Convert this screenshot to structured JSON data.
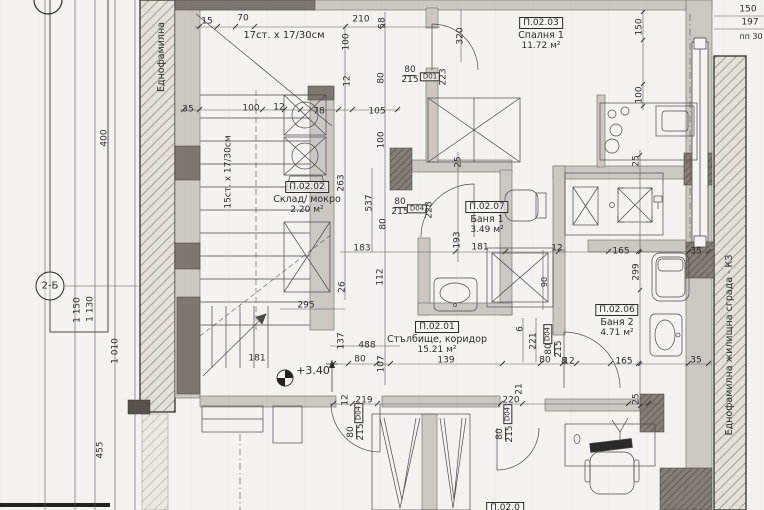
{
  "palette": {
    "paper": "#f3f2ef",
    "ink": "#3c3c3c",
    "wall_light": "#cbc7c2",
    "wall_dark": "#7d7772"
  },
  "side_labels": {
    "left": "Еднофамилна",
    "right": "Еднофамилна жилищна сграда - КЗ"
  },
  "grid_markers": [
    {
      "label": "2-Б",
      "x": 50,
      "y": 286
    }
  ],
  "level_marker": {
    "label": "+3.40"
  },
  "stair_notes": {
    "top": "17ст. х 17/30см",
    "side": "15ст. х 17/30см"
  },
  "rooms": [
    {
      "id": "П.02.01",
      "name": "Стълбище, коридор",
      "area": "15.21 м²",
      "x": 437,
      "y": 338
    },
    {
      "id": "П.02.02",
      "name": "Склад/ мокро",
      "area": "2.20 м²",
      "x": 307,
      "y": 198
    },
    {
      "id": "П.02.03",
      "name": "Спалня 1",
      "area": "11.72 м²",
      "x": 541,
      "y": 34
    },
    {
      "id": "П.02.06",
      "name": "Баня 2",
      "area": "4.71 м²",
      "x": 617,
      "y": 321
    },
    {
      "id": "П.02.07",
      "name": "Баня 1",
      "area": "3.49 м²",
      "x": 487,
      "y": 218
    },
    {
      "id": "П.02.0",
      "name": "",
      "area": "",
      "x": 505,
      "y": 508
    }
  ],
  "texts": [
    {
      "t": "15",
      "x": 207,
      "y": 22
    },
    {
      "t": "70",
      "x": 243,
      "y": 19
    },
    {
      "t": "210",
      "x": 361,
      "y": 20
    },
    {
      "t": "58",
      "x": 383,
      "y": 23,
      "r": -90
    },
    {
      "t": "320",
      "x": 461,
      "y": 36,
      "r": -90
    },
    {
      "t": "150",
      "x": 748,
      "y": 10
    },
    {
      "t": "197",
      "x": 750,
      "y": 23
    },
    {
      "t": "пп 30",
      "x": 751,
      "y": 37,
      "s": 8,
      "n": "note-pp30"
    },
    {
      "t": "150",
      "x": 640,
      "y": 27,
      "r": -90
    },
    {
      "t": "100",
      "x": 640,
      "y": 95,
      "r": -90
    },
    {
      "t": "100",
      "x": 347,
      "y": 42,
      "r": -90
    },
    {
      "t": "12",
      "x": 348,
      "y": 81,
      "r": -90
    },
    {
      "t": "80",
      "x": 382,
      "y": 78,
      "r": -90
    },
    {
      "t": "35",
      "x": 188,
      "y": 110
    },
    {
      "t": "100",
      "x": 251,
      "y": 109
    },
    {
      "t": "12",
      "x": 279,
      "y": 108
    },
    {
      "t": "78",
      "x": 319,
      "y": 112
    },
    {
      "t": "105",
      "x": 377,
      "y": 112
    },
    {
      "t": "263",
      "x": 342,
      "y": 183,
      "r": -90
    },
    {
      "t": "100",
      "x": 382,
      "y": 140,
      "r": -90
    },
    {
      "t": "537",
      "x": 370,
      "y": 203,
      "r": -90
    },
    {
      "t": "80",
      "x": 384,
      "y": 224,
      "r": -90
    },
    {
      "t": "183",
      "x": 362,
      "y": 249
    },
    {
      "t": "112",
      "x": 381,
      "y": 277,
      "r": -90
    },
    {
      "t": "26",
      "x": 343,
      "y": 287,
      "r": -90
    },
    {
      "t": "295",
      "x": 306,
      "y": 306
    },
    {
      "t": "137",
      "x": 342,
      "y": 341,
      "r": -90
    },
    {
      "t": "488",
      "x": 367,
      "y": 346
    },
    {
      "t": "80",
      "x": 360,
      "y": 360
    },
    {
      "t": "107",
      "x": 382,
      "y": 364,
      "r": -90
    },
    {
      "t": "139",
      "x": 446,
      "y": 361
    },
    {
      "t": "80",
      "x": 545,
      "y": 361
    },
    {
      "t": "8",
      "x": 564,
      "y": 362
    },
    {
      "t": "181",
      "x": 257,
      "y": 359
    },
    {
      "t": "12",
      "x": 346,
      "y": 400,
      "r": -90
    },
    {
      "t": "219",
      "x": 364,
      "y": 401
    },
    {
      "t": "220",
      "x": 511,
      "y": 401
    },
    {
      "t": "21",
      "x": 520,
      "y": 389,
      "r": -90
    },
    {
      "t": "25",
      "x": 637,
      "y": 399,
      "r": -90
    },
    {
      "t": "6",
      "x": 521,
      "y": 329,
      "r": -90
    },
    {
      "t": "221",
      "x": 534,
      "y": 341,
      "r": -90
    },
    {
      "t": "165",
      "x": 621,
      "y": 252
    },
    {
      "t": "35",
      "x": 696,
      "y": 252
    },
    {
      "t": "299",
      "x": 637,
      "y": 272,
      "r": -90
    },
    {
      "t": "165",
      "x": 624,
      "y": 362
    },
    {
      "t": "12",
      "x": 569,
      "y": 362
    },
    {
      "t": "35",
      "x": 696,
      "y": 361
    },
    {
      "t": "25",
      "x": 459,
      "y": 162,
      "r": -90
    },
    {
      "t": "25",
      "x": 637,
      "y": 161,
      "r": -90
    },
    {
      "t": "193",
      "x": 458,
      "y": 240,
      "r": -90
    },
    {
      "t": "181",
      "x": 480,
      "y": 248
    },
    {
      "t": "12",
      "x": 557,
      "y": 249
    },
    {
      "t": "90",
      "x": 545,
      "y": 282,
      "r": -90,
      "s": 8
    },
    {
      "t": "400",
      "x": 105,
      "y": 138,
      "r": -90
    },
    {
      "t": "1 150",
      "x": 78,
      "y": 310,
      "r": -90
    },
    {
      "t": "1 130",
      "x": 91,
      "y": 309,
      "r": -90
    },
    {
      "t": "1 010",
      "x": 116,
      "y": 351,
      "r": -90
    },
    {
      "t": "455",
      "x": 101,
      "y": 450,
      "r": -90
    },
    {
      "t": "+3.40",
      "x": 313,
      "y": 371,
      "s": 11,
      "n": "level-marker-label"
    },
    {
      "t": "17ст. х 17/30см",
      "x": 284,
      "y": 36,
      "s": 10,
      "n": "stair-note-top"
    },
    {
      "t": "15ст. х 17/30см",
      "x": 229,
      "y": 172,
      "r": -90,
      "n": "stair-note-side"
    },
    {
      "t": "Еднофамилна",
      "x": 162,
      "y": 57,
      "r": -90,
      "s": 9.5,
      "n": "side-label-left"
    },
    {
      "t": "Еднофамилна жилищна сграда - КЗ",
      "x": 730,
      "y": 345,
      "r": -90,
      "s": 9.5,
      "n": "side-label-right"
    },
    {
      "f": "80/215",
      "x": 410,
      "y": 76,
      "n": "door-size-label"
    },
    {
      "t": "D01",
      "x": 430,
      "y": 77,
      "b": true,
      "s": 7,
      "n": "door-code-label"
    },
    {
      "t": "223",
      "x": 444,
      "y": 77,
      "r": -90
    },
    {
      "f": "80/215",
      "x": 400,
      "y": 208,
      "n": "door-size-label"
    },
    {
      "t": "D04",
      "x": 417,
      "y": 209,
      "b": true,
      "s": 7,
      "n": "door-code-label"
    },
    {
      "t": "228",
      "x": 430,
      "y": 210,
      "r": -90
    },
    {
      "f": "80/215",
      "x": 555,
      "y": 349,
      "r": -90,
      "n": "door-size-label"
    },
    {
      "t": "D04",
      "x": 548,
      "y": 334,
      "b": true,
      "s": 7,
      "r": -90,
      "n": "door-code-label"
    },
    {
      "f": "80/215",
      "x": 357,
      "y": 432,
      "r": -90,
      "n": "door-size-label"
    },
    {
      "t": "D04",
      "x": 359,
      "y": 413,
      "b": true,
      "s": 7,
      "r": -90,
      "n": "door-code-label"
    },
    {
      "f": "80/215",
      "x": 506,
      "y": 434,
      "r": -90,
      "n": "door-size-label"
    },
    {
      "t": "D04",
      "x": 508,
      "y": 414,
      "b": true,
      "s": 7,
      "r": -90,
      "n": "door-code-label"
    }
  ]
}
